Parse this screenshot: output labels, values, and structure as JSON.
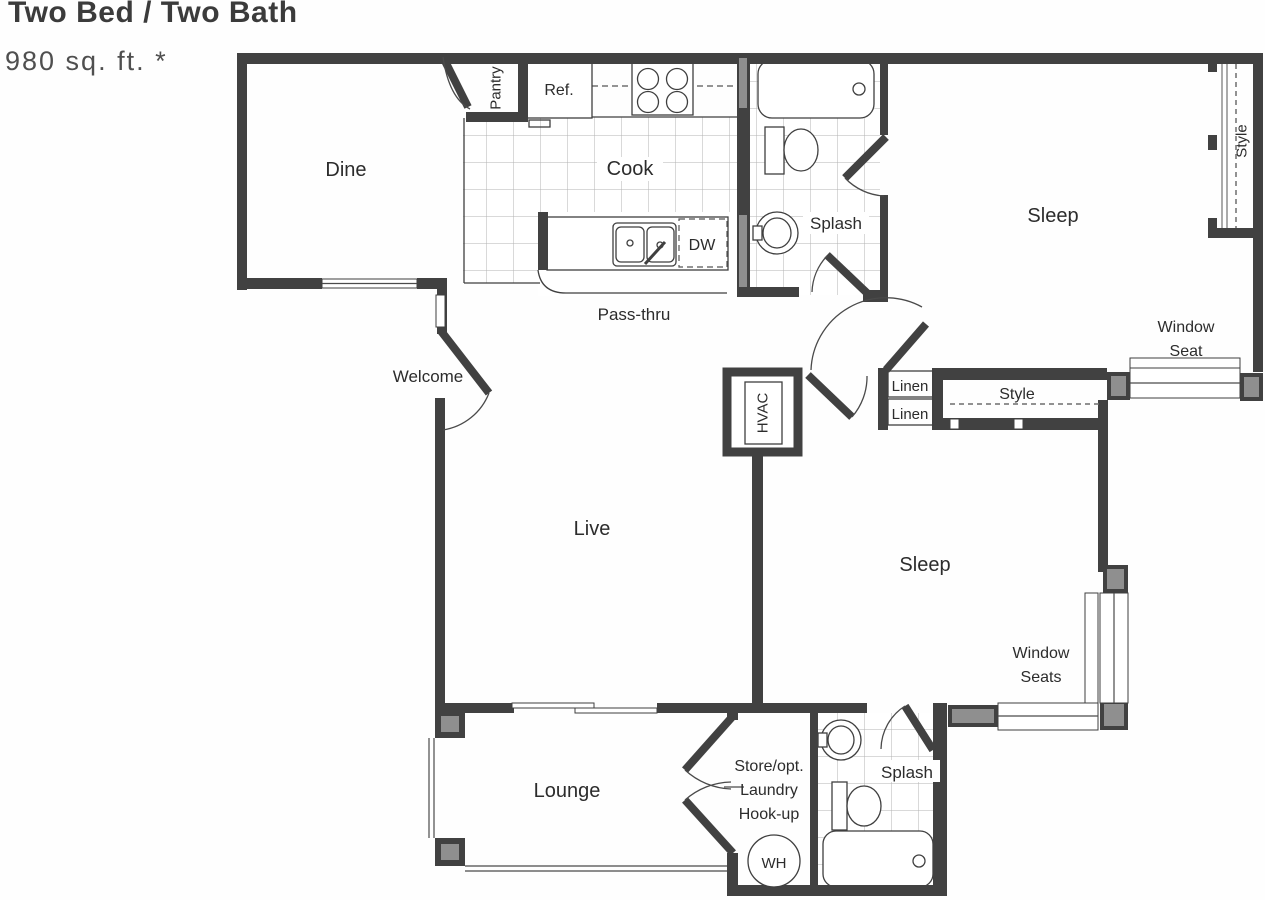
{
  "header": {
    "title": "Two Bed / Two Bath",
    "area": "980 sq. ft. *"
  },
  "rooms": {
    "dine": "Dine",
    "cook": "Cook",
    "live": "Live",
    "lounge": "Lounge",
    "sleep_upper": "Sleep",
    "sleep_lower": "Sleep",
    "bath_upper": "Splash",
    "bath_lower": "Splash",
    "entry": "Welcome"
  },
  "features": {
    "pantry": "Pantry",
    "fridge": "Ref.",
    "dishwasher": "DW",
    "pass_thru": "Pass-thru",
    "hvac": "HVAC",
    "linen_upper": "Linen",
    "linen_lower": "Linen",
    "closet_hall": "Style",
    "closet_bedroom": "Style",
    "window_seat_upper_l1": "Window",
    "window_seat_upper_l2": "Seat",
    "window_seat_lower_l1": "Window",
    "window_seat_lower_l2": "Seats",
    "laundry_l1": "Store/opt.",
    "laundry_l2": "Laundry",
    "laundry_l3": "Hook-up",
    "water_heater": "WH"
  },
  "colors": {
    "wall": "#414141",
    "post_fill": "#8f8f8f",
    "line": "#3f3f3f",
    "tile_line": "#b3b3b3",
    "text": "#2c2c2c",
    "title": "#3b3b3b",
    "background": "#ffffff"
  }
}
